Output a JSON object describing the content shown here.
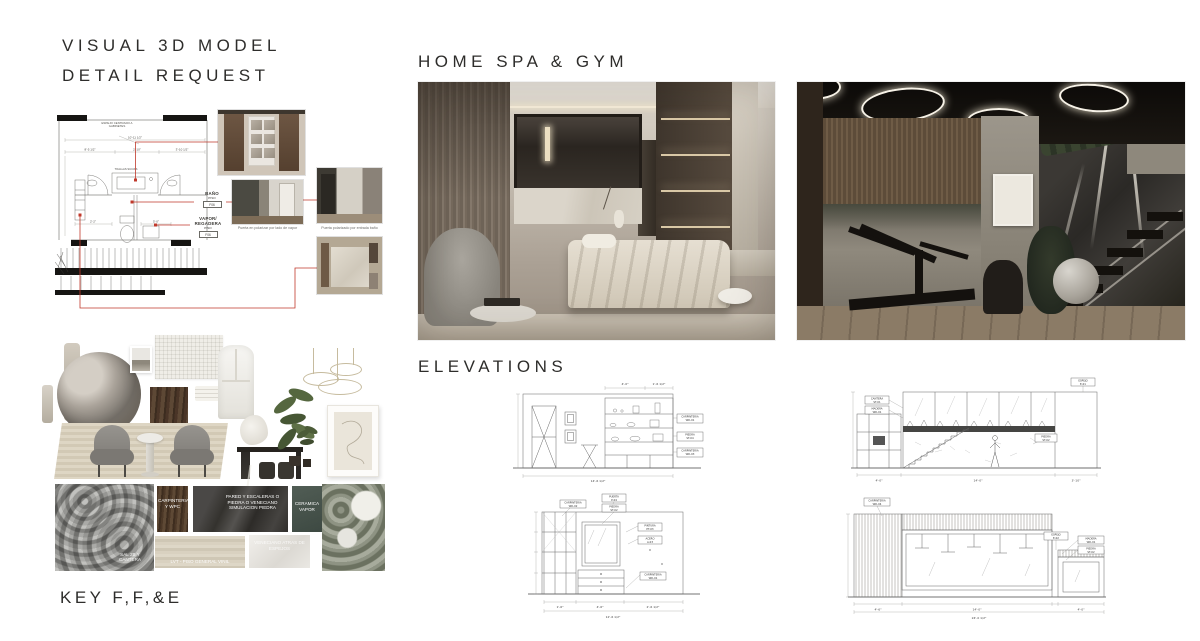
{
  "titles": {
    "visual1": "VISUAL 3D MODEL",
    "visual2": "DETAIL REQUEST",
    "homespa": "HOME SPA & GYM",
    "elevations": "ELEVATIONS",
    "key": "KEY F,F,&E"
  },
  "plan": {
    "note_espejo": "ESPEJO CENTRADO A GABINETES",
    "note_toallas": "TOALLAS SUCIAS",
    "dim_top": "10'-11 1/2\"",
    "dim_a": "8'-5 1/2\"",
    "dim_b": "2'-10\"",
    "dim_c": "3'-10 1/2\"",
    "dim_d": "2'-2\"",
    "dim_e": "5'-0\"",
    "bano": {
      "title": "BAÑO",
      "sub": "PISO",
      "code": "F06"
    },
    "vapor": {
      "title": "VAPOR/",
      "title2": "REGADERA",
      "sub": "PISO",
      "code": "F06"
    },
    "caption_steam": "Puerta en polarizar por lado de vapor",
    "caption_entry": "Puerta polarizado por entrada baño"
  },
  "materials": {
    "granite": "SAL 2B Y CANTERA",
    "wood": "CARPINTERIA Y WPC",
    "stone": "PARED Y ESCALERAS O PIEDRA O VENECIANO SIMULACION PIEDRA",
    "ceramic": "CERAMICA VAPOR",
    "lvt": "LVT - PISO GENERAL VINIL",
    "veneciano": "VENECIANO ATRAS DE ESPEJOS"
  },
  "elev": {
    "e1": {
      "c1a": "CARPINTERIA",
      "c1b": "WD-01",
      "c2a": "PIEDRA",
      "c2b": "ST-04",
      "c3a": "CARPINTERIA",
      "c3b": "WD-03",
      "d1": "4'-0\"",
      "d2": "1'-6 1/2\"",
      "d3": "14'-6 1/2\""
    },
    "e2": {
      "c1a": "CANTERA",
      "c1b": "ST-01",
      "c2a": "MADERA",
      "c2b": "WD-01",
      "c3a": "ESPEJO",
      "c3b": "E-01",
      "c4a": "PIEDRA",
      "c4b": "ST-02",
      "d1": "4'-0\"",
      "d2": "14'-0\"",
      "d3": "3'-10\""
    },
    "e3": {
      "cla": "CARPINTERIA",
      "clb": "WD-02",
      "ct1a": "PUERTA",
      "ct1b": "P-04",
      "ct2a": "PIEDRA",
      "ct2b": "ST-02",
      "cr1a": "PINTURA",
      "cr1b": "PT-03",
      "cr2a": "ACERO",
      "cr2b": "A-03",
      "cr3a": "CARPINTERIA",
      "cr3b": "WD-01",
      "d1": "1'-6\"",
      "d2": "4'-6\"",
      "d3": "2'-6 1/2\"",
      "dt": "12'-6 1/2\""
    },
    "e4": {
      "c1a": "CARPINTERIA",
      "c1b": "WD-04",
      "c2a": "ESPEJO",
      "c2b": "E-02",
      "c3a": "MADERA",
      "c3b": "WD-01",
      "c4a": "PIEDRA",
      "c4b": "ST-02",
      "d1": "4'-6\"",
      "d2": "14'-0\"",
      "d3": "4'-0\"",
      "dt": "24'-0 1/2\""
    }
  },
  "colors": {
    "annotation_red": "#c0392b",
    "ink": "#2e2d2b",
    "paper": "#ffffff"
  }
}
